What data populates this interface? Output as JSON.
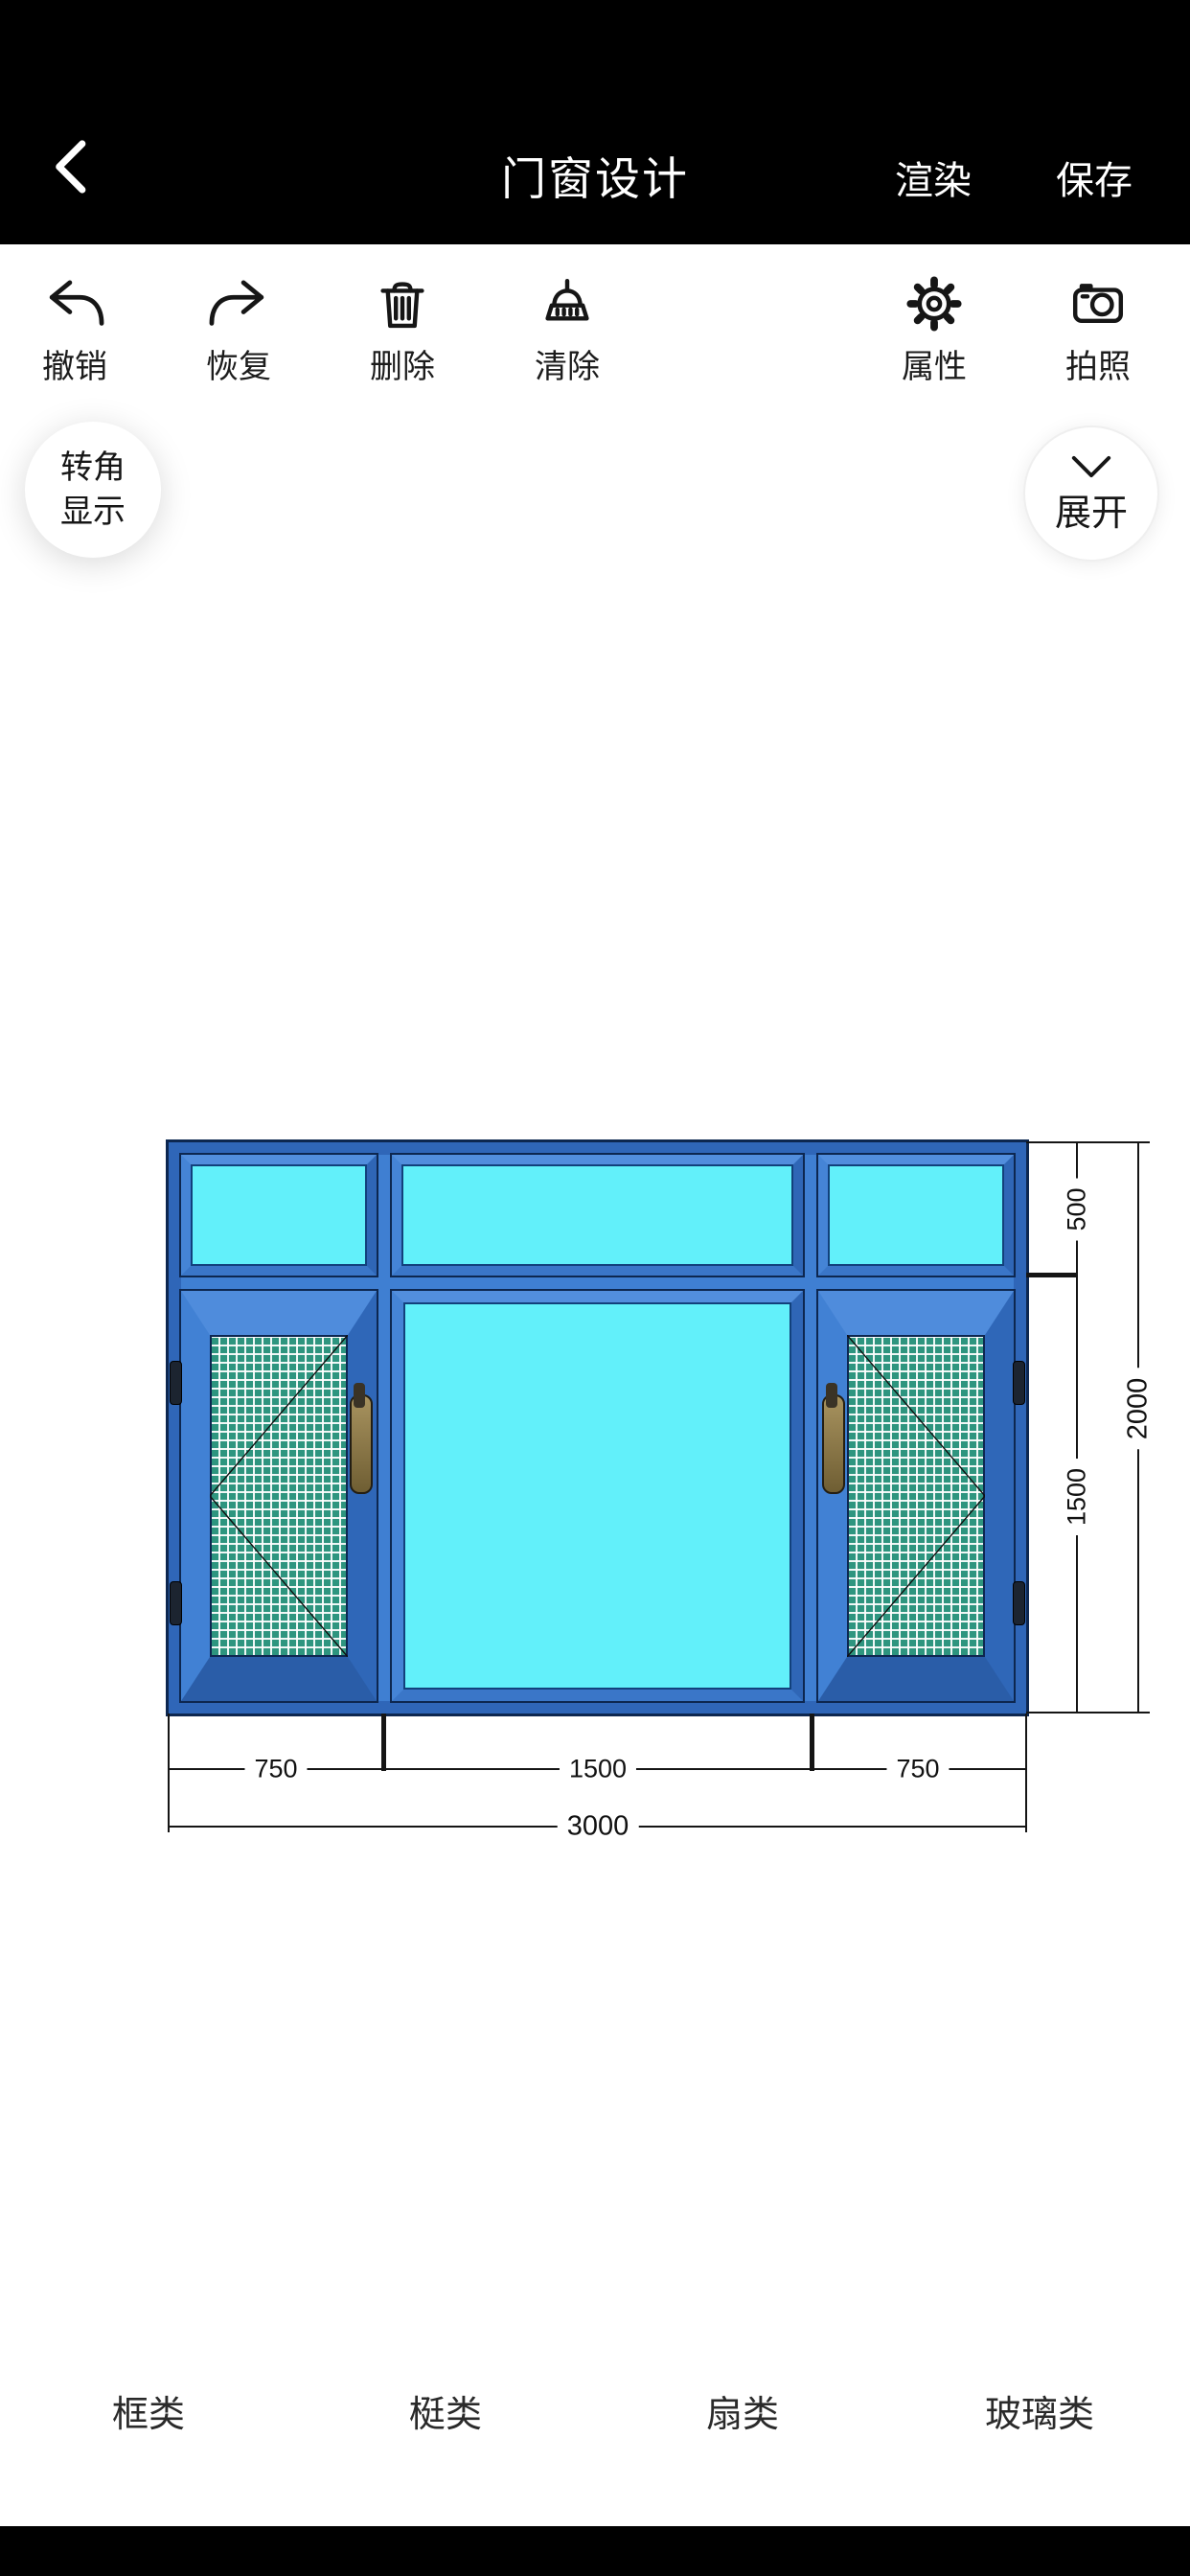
{
  "header": {
    "title": "门窗设计",
    "render_label": "渲染",
    "save_label": "保存"
  },
  "toolbar": {
    "undo_label": "撤销",
    "redo_label": "恢复",
    "delete_label": "删除",
    "clear_label": "清除",
    "props_label": "属性",
    "photo_label": "拍照"
  },
  "floating": {
    "corner_line1": "转角",
    "corner_line2": "显示",
    "expand_label": "展开"
  },
  "drawing": {
    "dims": {
      "h_top": "500",
      "h_main": "1500",
      "h_total": "2000",
      "w_left": "750",
      "w_center": "1500",
      "w_right": "750",
      "w_total": "3000"
    },
    "colors": {
      "frame_blue": "#2f66b8",
      "face_blue": "#4181d4",
      "glass_cyan": "#62f0fa",
      "mesh_teal": "#2e957f",
      "outline_dark": "#0d2750"
    }
  },
  "tabs": [
    {
      "label": "框类"
    },
    {
      "label": "梃类"
    },
    {
      "label": "扇类"
    },
    {
      "label": "玻璃类"
    }
  ]
}
